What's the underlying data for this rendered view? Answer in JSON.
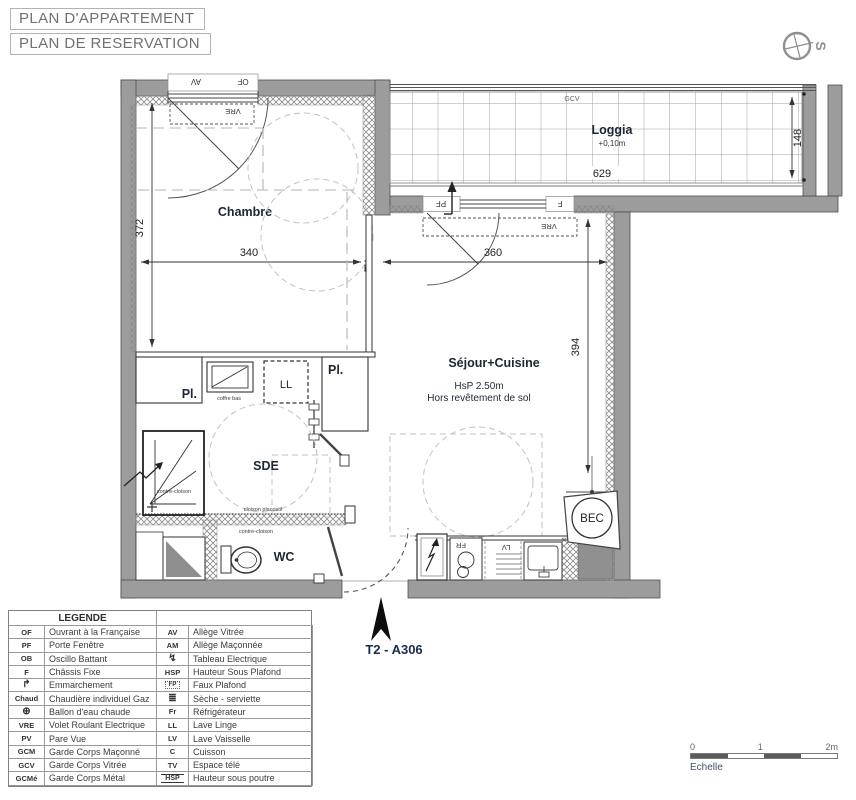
{
  "header": {
    "title1": "PLAN D'APPARTEMENT",
    "title2": "PLAN DE RESERVATION"
  },
  "compass": {
    "label": "S"
  },
  "plan": {
    "unit_label": "T2 - A306",
    "rooms": {
      "chambre": "Chambre",
      "sejour": "Séjour+Cuisine",
      "sejour_hsp": "HsP 2.50m",
      "sejour_floor": "Hors revêtement de sol",
      "loggia": "Loggia",
      "loggia_level": "+0,10m",
      "sde": "SDE",
      "wc": "WC"
    },
    "dims": {
      "d340": "340",
      "d372": "372",
      "d360": "360",
      "d394": "394",
      "d629": "629",
      "d148": "148"
    },
    "ann": {
      "av": "AV",
      "of": "OF",
      "vre1": "VRE",
      "vre2": "VRE",
      "pf": "PF",
      "f": "F",
      "gcv": "GCV",
      "tv": "TV",
      "pl1": "Pl.",
      "pl2": "Pl.",
      "ll": "LL",
      "coffre": "coffre bas",
      "contre1": "contre-cloison",
      "contre2": "contre-cloison",
      "cloison": "cloison placostil",
      "fr": "FR",
      "lv": "LV",
      "bec": "BEC"
    }
  },
  "legend": {
    "title": "LEGENDE",
    "rows": [
      {
        "left": {
          "key": "OF",
          "label": "Ouvrant à la Française"
        },
        "right": {
          "key": "AV",
          "label": "Allège Vitrée"
        }
      },
      {
        "left": {
          "key": "PF",
          "label": "Porte Fenêtre"
        },
        "right": {
          "key": "AM",
          "label": "Allège Maçonnée"
        }
      },
      {
        "left": {
          "key": "OB",
          "label": "Oscillo Battant"
        },
        "right": {
          "icon": "zigzag-electric-icon",
          "glyph": "↯",
          "label": "Tableau Electrique"
        }
      },
      {
        "left": {
          "key": "F",
          "label": "Châssis Fixe"
        },
        "right": {
          "key": "HSP",
          "label": "Hauteur Sous Plafond"
        }
      },
      {
        "left": {
          "icon": "step-arrow-icon",
          "glyph": "↱",
          "label": "Emmarchement"
        },
        "right": {
          "icon": "faux-plafond-icon",
          "boxed": "FP",
          "label": "Faux Plafond"
        }
      },
      {
        "left": {
          "key": "Chaud",
          "label": "Chaudière individuel Gaz"
        },
        "right": {
          "icon": "radiator-icon",
          "glyph": "≣",
          "label": "Sèche - serviette"
        }
      },
      {
        "left": {
          "icon": "water-heater-icon",
          "glyph": "⊕",
          "label": "Ballon d'eau chaude"
        },
        "right": {
          "key": "Fr",
          "label": "Réfrigérateur"
        }
      },
      {
        "left": {
          "key": "VRE",
          "label": "Volet Roulant Electrique"
        },
        "right": {
          "key": "LL",
          "label": "Lave Linge"
        }
      },
      {
        "left": {
          "key": "PV",
          "label": "Pare Vue"
        },
        "right": {
          "key": "LV",
          "label": "Lave Vaisselle"
        }
      },
      {
        "left": {
          "key": "GCM",
          "label": "Garde Corps Maçonné"
        },
        "right": {
          "key": "C",
          "label": "Cuisson"
        }
      },
      {
        "left": {
          "key": "GCV",
          "label": "Garde Corps Vitrée"
        },
        "right": {
          "key": "TV",
          "label": "Espace télé"
        }
      },
      {
        "left": {
          "key": "GCMé",
          "label": "Garde Corps Métal"
        },
        "right": {
          "icon": "hsp-beam-icon",
          "lined": "HSP",
          "label": "Hauteur sous poutre"
        }
      }
    ]
  },
  "scalebar": {
    "t0": "0",
    "t1": "1",
    "t2": "2m",
    "label": "Echelle"
  },
  "colors": {
    "wall_gray": "#9c9c9c",
    "line_dark": "#333333",
    "label_navy": "#1c2b4a",
    "dash_gray": "#c2c2c2"
  }
}
